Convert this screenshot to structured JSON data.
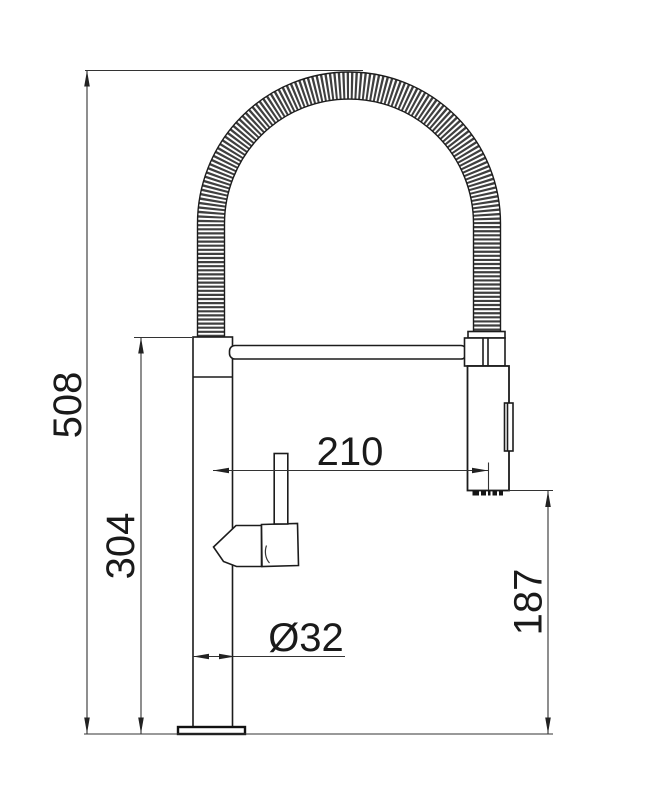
{
  "drawing": {
    "kind": "technical dimension drawing",
    "subject": "pull-down spring kitchen faucet, side view",
    "colors": {
      "outline": "#1c1c1c",
      "dimension_lines": "#333333",
      "hose_ribs": "#3f3f3f",
      "text": "#1a1a1a",
      "background": "#ffffff"
    },
    "dimension_labels": {
      "overall_height": "508",
      "body_height": "304",
      "spout_reach": "210",
      "base_diameter": "Ø32",
      "outlet_clearance": "187"
    }
  }
}
